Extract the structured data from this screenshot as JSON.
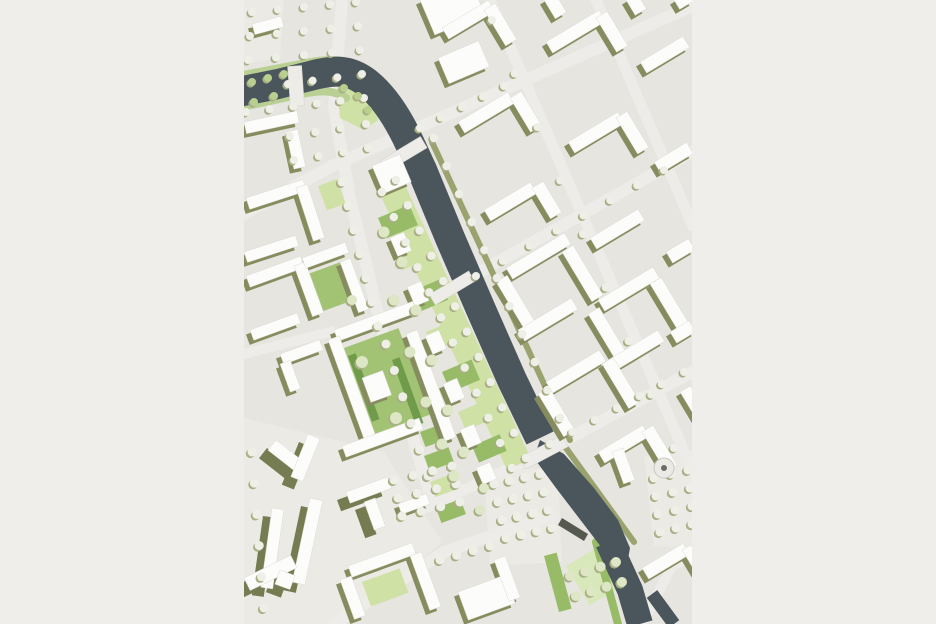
{
  "page": {
    "background": "#efeeea",
    "map_left": 244,
    "map_top": 0,
    "map_width": 448,
    "map_height": 624
  },
  "map": {
    "title": "urban-masterplan-site-plan",
    "palette": {
      "base": "#e6e5e0",
      "plaza": "#eceae5",
      "road": "#edece8",
      "water": "#4a565c",
      "building": "#fcfcfa",
      "building_edge": "#d8d7cf",
      "shadow": "#868c5e",
      "shadow_tall": "#767c52",
      "green_light": "#cfe1a5",
      "green_mid": "#97bb66",
      "green_court": "#a2c274",
      "green_pale": "#d9e8ba",
      "green_dark": "#6f9b4a",
      "green_bank": "#b9cf93",
      "olive_bank": "#9aa26e",
      "tree_std": "#eef0e7",
      "tree_park": "#dde7c6",
      "tree_bush": "#b9cf8e",
      "tree_shadow": "#a9ae85",
      "monument": "#55594f",
      "roundabout_dot": "#6b6e62"
    },
    "plazas": [
      {
        "pts": "0,418 140,452 198,542 98,624 0,624"
      },
      {
        "pts": "240,470 314,468 318,562 246,566"
      },
      {
        "pts": "400,456 448,450 448,548 410,546"
      },
      {
        "pts": "0,0 40,0 36,58 0,64"
      }
    ],
    "roads": [
      {
        "d": "M 98 0 L 90 108 L 106 198 L 138 330 L 166 428 L 188 502",
        "w": 12
      },
      {
        "d": "M 0 214 L 88 166 L 448 6",
        "w": 12
      },
      {
        "d": "M 0 354 L 86 332",
        "w": 10
      },
      {
        "d": "M 208 288 L 448 152",
        "w": 12
      },
      {
        "d": "M 300 452 L 448 372",
        "w": 12
      },
      {
        "d": "M 246 0 L 448 470",
        "w": 11
      },
      {
        "d": "M 352 0 L 448 224",
        "w": 11
      },
      {
        "d": "M 90 624 L 200 552 L 306 516",
        "w": 12
      },
      {
        "d": "M 186 506 L 296 454",
        "w": 11
      },
      {
        "d": "M 398 624 L 428 566 L 448 556",
        "w": 10
      }
    ],
    "green_polys": [
      {
        "pts": "155,172 287,459 263,470 131,183",
        "tone": "light"
      },
      {
        "pts": "92,78 128,82 134,120 120,130 96,118",
        "tone": "light"
      }
    ],
    "green_rects": [
      [
        134,
        218,
        34,
        22,
        -23,
        "mid"
      ],
      [
        150,
        252,
        30,
        20,
        -23,
        "light"
      ],
      [
        166,
        292,
        32,
        22,
        -23,
        "mid"
      ],
      [
        182,
        332,
        30,
        20,
        -23,
        "light"
      ],
      [
        198,
        372,
        32,
        22,
        -23,
        "mid"
      ],
      [
        214,
        412,
        30,
        20,
        -23,
        "light"
      ],
      [
        228,
        446,
        30,
        18,
        -23,
        "mid"
      ],
      [
        64,
        274,
        34,
        40,
        -20,
        "court"
      ],
      [
        100,
        348,
        58,
        92,
        -20,
        "court"
      ],
      [
        104,
        356,
        8,
        70,
        -20,
        "dark"
      ],
      [
        148,
        360,
        8,
        70,
        -20,
        "dark"
      ],
      [
        74,
        186,
        20,
        26,
        -20,
        "light"
      ],
      [
        176,
        432,
        24,
        16,
        -20,
        "mid"
      ],
      [
        180,
        456,
        26,
        16,
        -20,
        "mid"
      ],
      [
        186,
        482,
        26,
        16,
        -20,
        "light"
      ],
      [
        192,
        508,
        26,
        16,
        -20,
        "mid"
      ],
      [
        322,
        566,
        54,
        46,
        -31,
        "pale"
      ],
      [
        300,
        556,
        13,
        58,
        -15,
        "mid"
      ],
      [
        118,
        582,
        40,
        26,
        -20,
        "light"
      ]
    ],
    "banks": [
      {
        "d": "M -6 76 L 62 63 C 90 57 110 60 128 74",
        "w": 8,
        "tone": "green_bank"
      },
      {
        "d": "M -6 108 L 58 94 C 78 90 90 90 102 98",
        "w": 8,
        "tone": "green_bank"
      },
      {
        "d": "M 188 142 L 326 440",
        "w": 6,
        "tone": "olive_bank"
      },
      {
        "d": "M 322 448 L 390 542",
        "w": 6,
        "tone": "olive_bank"
      },
      {
        "d": "M 352 542 L 374 624",
        "w": 8,
        "tone": "green_mid"
      }
    ],
    "water_paths": [
      {
        "d": "M -6 92 L 34 84 L 66 76 C 92 69 106 70 122 82 C 140 96 154 118 166 144 L 178 170 L 206 238 L 238 312 L 268 380 L 296 438",
        "w": 30
      },
      {
        "d": "M 364 542 L 386 590 L 396 624",
        "w": 26
      },
      {
        "d": "M 408 594 L 430 624",
        "w": 13
      }
    ],
    "water_polys": [
      {
        "pts": "296,440 320,454 350,488 374,520 386,548 382,570 364,556 338,522 312,488 290,458"
      }
    ],
    "bridges": [
      [
        52,
        86,
        40,
        14,
        86
      ],
      [
        160,
        154,
        46,
        13,
        -31
      ],
      [
        208,
        288,
        46,
        12,
        -31
      ],
      [
        300,
        452,
        48,
        13,
        -28
      ]
    ],
    "buildings": [
      [
        8,
        24,
        30,
        11,
        -15,
        0
      ],
      [
        0,
        122,
        54,
        12,
        -12,
        0
      ],
      [
        42,
        132,
        12,
        38,
        -12,
        0
      ],
      [
        2,
        198,
        60,
        12,
        -18,
        0
      ],
      [
        52,
        188,
        12,
        56,
        -18,
        0
      ],
      [
        0,
        252,
        54,
        11,
        -18,
        0
      ],
      [
        2,
        276,
        58,
        12,
        -20,
        0
      ],
      [
        50,
        266,
        12,
        54,
        -20,
        0
      ],
      [
        6,
        330,
        50,
        11,
        -20,
        0
      ],
      [
        58,
        258,
        46,
        11,
        -20,
        0
      ],
      [
        96,
        262,
        11,
        54,
        -20,
        0
      ],
      [
        90,
        330,
        84,
        12,
        -20,
        0
      ],
      [
        84,
        340,
        12,
        114,
        -20,
        0
      ],
      [
        98,
        446,
        82,
        12,
        -20,
        0
      ],
      [
        162,
        334,
        12,
        114,
        -20,
        0
      ],
      [
        118,
        378,
        22,
        26,
        -20,
        0
      ],
      [
        36,
        354,
        42,
        11,
        -20,
        0
      ],
      [
        36,
        364,
        11,
        30,
        -20,
        0
      ],
      [
        32,
        440,
        42,
        13,
        38,
        1
      ],
      [
        64,
        434,
        13,
        46,
        22,
        1
      ],
      [
        66,
        498,
        13,
        86,
        12,
        1
      ],
      [
        28,
        508,
        12,
        80,
        8,
        1
      ],
      [
        0,
        578,
        52,
        14,
        -26,
        1
      ],
      [
        36,
        570,
        16,
        15,
        20,
        1
      ],
      [
        102,
        492,
        44,
        12,
        -20,
        1
      ],
      [
        120,
        502,
        12,
        30,
        -20,
        1
      ],
      [
        154,
        504,
        30,
        11,
        -20,
        0
      ],
      [
        104,
        566,
        68,
        12,
        -20,
        0
      ],
      [
        96,
        580,
        12,
        42,
        -20,
        0
      ],
      [
        166,
        556,
        12,
        58,
        -20,
        0
      ],
      [
        214,
        592,
        50,
        30,
        -20,
        0
      ],
      [
        250,
        560,
        12,
        44,
        -20,
        0
      ],
      [
        128,
        166,
        30,
        30,
        -23,
        0
      ],
      [
        146,
        238,
        15,
        20,
        -23,
        0
      ],
      [
        163,
        287,
        15,
        21,
        -23,
        0
      ],
      [
        181,
        336,
        15,
        20,
        -23,
        0
      ],
      [
        199,
        384,
        15,
        21,
        -23,
        0
      ],
      [
        216,
        430,
        15,
        20,
        -23,
        0
      ],
      [
        232,
        468,
        15,
        18,
        -23,
        0
      ],
      [
        176,
        0,
        54,
        38,
        -23,
        0
      ],
      [
        194,
        58,
        44,
        28,
        -23,
        0
      ],
      [
        198,
        28,
        54,
        13,
        -31,
        0
      ],
      [
        240,
        10,
        13,
        42,
        -31,
        0
      ],
      [
        214,
        122,
        58,
        13,
        -31,
        0
      ],
      [
        266,
        98,
        13,
        40,
        -31,
        0
      ],
      [
        240,
        210,
        54,
        13,
        -31,
        0
      ],
      [
        288,
        188,
        13,
        36,
        -31,
        0
      ],
      [
        302,
        42,
        62,
        13,
        -31,
        0
      ],
      [
        352,
        18,
        13,
        40,
        -31,
        0
      ],
      [
        324,
        142,
        58,
        13,
        -31,
        0
      ],
      [
        372,
        118,
        13,
        42,
        -31,
        0
      ],
      [
        346,
        238,
        56,
        13,
        -31,
        0
      ],
      [
        396,
        62,
        50,
        13,
        -31,
        0
      ],
      [
        410,
        162,
        38,
        13,
        -31,
        0
      ],
      [
        422,
        252,
        26,
        13,
        -31,
        0
      ],
      [
        300,
        0,
        13,
        22,
        -31,
        0
      ],
      [
        382,
        0,
        13,
        18,
        -31,
        0
      ],
      [
        430,
        0,
        16,
        11,
        -31,
        0
      ],
      [
        262,
        268,
        68,
        13,
        -31,
        0
      ],
      [
        252,
        282,
        13,
        56,
        -31,
        0
      ],
      [
        318,
        252,
        13,
        58,
        -31,
        0
      ],
      [
        274,
        330,
        62,
        13,
        -31,
        0
      ],
      [
        354,
        300,
        64,
        13,
        -31,
        0
      ],
      [
        344,
        314,
        13,
        54,
        -31,
        0
      ],
      [
        406,
        284,
        13,
        56,
        -31,
        0
      ],
      [
        364,
        360,
        58,
        13,
        -31,
        0
      ],
      [
        302,
        382,
        62,
        13,
        -31,
        0
      ],
      [
        294,
        394,
        13,
        50,
        -31,
        0
      ],
      [
        358,
        364,
        13,
        52,
        -31,
        0
      ],
      [
        426,
        332,
        22,
        13,
        -31,
        0
      ],
      [
        436,
        392,
        12,
        38,
        -31,
        0
      ],
      [
        354,
        452,
        52,
        13,
        -31,
        0
      ],
      [
        398,
        432,
        13,
        46,
        -31,
        0
      ],
      [
        368,
        452,
        12,
        34,
        -20,
        0
      ],
      [
        398,
        568,
        48,
        13,
        -31,
        0
      ],
      [
        438,
        550,
        10,
        38,
        -31,
        0
      ]
    ],
    "tree_rows": [
      [
        8,
        12,
        112,
        2,
        5,
        4,
        "std"
      ],
      [
        6,
        36,
        114,
        26,
        5,
        4,
        "std"
      ],
      [
        4,
        60,
        116,
        50,
        5,
        4,
        "std"
      ],
      [
        44,
        84,
        118,
        74,
        4,
        4,
        "std"
      ],
      [
        2,
        112,
        120,
        98,
        6,
        4,
        "std"
      ],
      [
        46,
        136,
        122,
        124,
        4,
        4,
        "std"
      ],
      [
        50,
        160,
        124,
        148,
        4,
        4,
        "std"
      ],
      [
        98,
        182,
        134,
        326,
        7,
        4.5,
        "std"
      ],
      [
        142,
        344,
        184,
        476,
        6,
        4.5,
        "std"
      ],
      [
        152,
        180,
        282,
        458,
        12,
        4.2,
        "std"
      ],
      [
        138,
        192,
        268,
        468,
        12,
        4.2,
        "std"
      ],
      [
        190,
        138,
        316,
        418,
        11,
        4.2,
        "std"
      ],
      [
        176,
        128,
        260,
        86,
        5,
        4,
        "std"
      ],
      [
        232,
        276,
        420,
        170,
        8,
        4,
        "std"
      ],
      [
        248,
        20,
        430,
        448,
        9,
        4,
        "std"
      ],
      [
        306,
        444,
        440,
        372,
        7,
        4,
        "std"
      ],
      [
        250,
        484,
        296,
        474,
        4,
        4.5,
        "std"
      ],
      [
        254,
        502,
        300,
        492,
        4,
        4.5,
        "std"
      ],
      [
        258,
        520,
        304,
        510,
        4,
        4.5,
        "std"
      ],
      [
        262,
        538,
        308,
        528,
        4,
        4.5,
        "std"
      ],
      [
        410,
        478,
        444,
        470,
        3,
        4.5,
        "std"
      ],
      [
        412,
        496,
        446,
        488,
        3,
        4.5,
        "std"
      ],
      [
        414,
        514,
        448,
        506,
        3,
        4.5,
        "std"
      ],
      [
        416,
        532,
        448,
        524,
        3,
        4.5,
        "std"
      ],
      [
        8,
        452,
        20,
        608,
        6,
        4.5,
        "std"
      ],
      [
        150,
        480,
        208,
        466,
        4,
        4.5,
        "std"
      ],
      [
        154,
        498,
        212,
        484,
        4,
        4.5,
        "std"
      ],
      [
        158,
        516,
        216,
        502,
        4,
        4.5,
        "std"
      ],
      [
        196,
        560,
        246,
        546,
        4,
        4.5,
        "std"
      ],
      [
        326,
        576,
        372,
        562,
        4,
        5,
        "park"
      ],
      [
        332,
        596,
        378,
        582,
        4,
        5,
        "park"
      ]
    ],
    "tree_singles": [
      [
        140,
        232,
        5.5,
        "park"
      ],
      [
        158,
        262,
        5.5,
        "park"
      ],
      [
        150,
        300,
        5.5,
        "park"
      ],
      [
        172,
        310,
        5.5,
        "park"
      ],
      [
        166,
        352,
        5.5,
        "park"
      ],
      [
        188,
        360,
        5.5,
        "park"
      ],
      [
        182,
        402,
        5.5,
        "park"
      ],
      [
        204,
        410,
        5.5,
        "park"
      ],
      [
        198,
        444,
        5.5,
        "park"
      ],
      [
        220,
        452,
        5.5,
        "park"
      ],
      [
        210,
        476,
        5.5,
        "park"
      ],
      [
        118,
        362,
        6,
        "park"
      ],
      [
        152,
        418,
        6,
        "park"
      ],
      [
        108,
        300,
        5,
        "park"
      ],
      [
        240,
        488,
        5,
        "park"
      ],
      [
        236,
        510,
        5,
        "park"
      ],
      [
        8,
        82,
        4,
        "bush"
      ],
      [
        24,
        78,
        4,
        "bush"
      ],
      [
        40,
        74,
        4,
        "bush"
      ],
      [
        100,
        88,
        4,
        "bush"
      ],
      [
        114,
        96,
        4,
        "bush"
      ],
      [
        124,
        110,
        4,
        "bush"
      ],
      [
        10,
        102,
        4,
        "bush"
      ],
      [
        30,
        96,
        4,
        "bush"
      ]
    ],
    "extras": {
      "monument_pts": "318,518 344,534 340,541 314,525",
      "roundabout": [
        420,
        468,
        10,
        3
      ]
    }
  }
}
